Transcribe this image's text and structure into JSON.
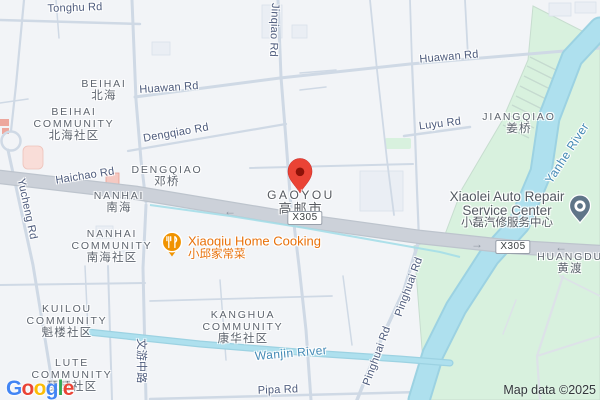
{
  "colors": {
    "background": "#f2f4f7",
    "green_area": "#d8f1de",
    "water_fill": "#a9dcec",
    "road_minor": "#cfd9e5",
    "road_major": "#c9ced7",
    "road_label": "#4d5b7c",
    "water_label": "#4389b5",
    "area_label": "#5d646e",
    "poi_orange": "#e8710a",
    "poi_gray_text": "#545a62",
    "pin_red": "#ea4335",
    "pin_gray": "#5f7588",
    "badge_border": "#99a1ab",
    "attribution_text": "#33373c"
  },
  "attribution": {
    "text": "Map data ©2025"
  },
  "logo": {
    "letters": [
      [
        "G",
        "#4285F4"
      ],
      [
        "o",
        "#EA4335"
      ],
      [
        "o",
        "#FBBC05"
      ],
      [
        "g",
        "#4285F4"
      ],
      [
        "l",
        "#34A853"
      ],
      [
        "e",
        "#EA4335"
      ]
    ]
  },
  "badges": [
    {
      "name": "route-badge-x305-west",
      "text": "X305",
      "x": 305,
      "y": 218
    },
    {
      "name": "route-badge-x305-east",
      "text": "X305",
      "x": 513,
      "y": 247
    }
  ],
  "arrows": [
    {
      "name": "oneway-arrow-west",
      "dir": "left",
      "x": 230,
      "y": 211
    },
    {
      "name": "oneway-arrow-mid",
      "dir": "right",
      "x": 477,
      "y": 244
    },
    {
      "name": "oneway-arrow-east",
      "dir": "left",
      "x": 561,
      "y": 247
    }
  ],
  "markers": [
    {
      "name": "destination-pin-gaoyou",
      "x": 300,
      "y": 176
    },
    {
      "name": "poi-pin-xiaoqiu-restaurant",
      "x": 172,
      "y": 242
    },
    {
      "name": "poi-pin-xiaolei-auto-repair",
      "x": 580,
      "y": 206
    }
  ],
  "labels": [
    {
      "name": "road-label-tonghu-rd",
      "cls": "road",
      "x": 75,
      "y": 8,
      "rot": -2,
      "lines": [
        "Tonghu Rd"
      ]
    },
    {
      "name": "road-label-huawan-rd-west",
      "cls": "road",
      "x": 169,
      "y": 88,
      "rot": -4,
      "lines": [
        "Huawan Rd"
      ]
    },
    {
      "name": "road-label-huawan-rd-east",
      "cls": "road",
      "x": 449,
      "y": 57,
      "rot": -5,
      "lines": [
        "Huawan Rd"
      ]
    },
    {
      "name": "road-label-jinqiao-rd",
      "cls": "road",
      "x": 274,
      "y": 30,
      "rot": 92,
      "lines": [
        "Jinqiao Rd"
      ]
    },
    {
      "name": "road-label-dengqiao-rd",
      "cls": "road",
      "x": 176,
      "y": 133,
      "rot": -10,
      "lines": [
        "Dengqiao Rd"
      ]
    },
    {
      "name": "road-label-haichao-rd",
      "cls": "road",
      "x": 85,
      "y": 176,
      "rot": -9,
      "lines": [
        "Haichao Rd"
      ]
    },
    {
      "name": "road-label-yucheng-rd",
      "cls": "road",
      "x": 27,
      "y": 209,
      "rot": 78,
      "lines": [
        "Yucheng Rd"
      ]
    },
    {
      "name": "road-label-luyu-rd",
      "cls": "road",
      "x": 440,
      "y": 124,
      "rot": -7,
      "lines": [
        "Luyu Rd"
      ]
    },
    {
      "name": "road-label-wenyou-middle-rd",
      "cls": "road",
      "x": 142,
      "y": 361,
      "rot": 90,
      "lines": [
        "文游中路"
      ]
    },
    {
      "name": "road-label-pipa-rd",
      "cls": "road",
      "x": 278,
      "y": 390,
      "rot": -2,
      "lines": [
        "Pipa Rd"
      ]
    },
    {
      "name": "road-label-pinghuai-rd-south",
      "cls": "road",
      "x": 377,
      "y": 356,
      "rot": -70,
      "lines": [
        "Pinghuai Rd"
      ]
    },
    {
      "name": "road-label-pinghuai-rd-north",
      "cls": "road",
      "x": 409,
      "y": 287,
      "rot": -70,
      "lines": [
        "Pinghuai Rd"
      ]
    },
    {
      "name": "water-label-yanhe-river",
      "cls": "water",
      "x": 567,
      "y": 153,
      "rot": -57,
      "lines": [
        "Yanhe River"
      ]
    },
    {
      "name": "water-label-wanjin-river",
      "cls": "water",
      "x": 291,
      "y": 353,
      "rot": -5,
      "lines": [
        "Wanjin River"
      ]
    },
    {
      "name": "area-label-beihai",
      "cls": "area",
      "x": 104,
      "y": 90,
      "lines": [
        "BEIHAI",
        "北海"
      ]
    },
    {
      "name": "area-label-beihai-community",
      "cls": "area",
      "x": 74,
      "y": 124,
      "lines": [
        "BEIHAI",
        "COMMUNITY",
        "北海社区"
      ]
    },
    {
      "name": "area-label-dengqiao",
      "cls": "area",
      "x": 167,
      "y": 176,
      "lines": [
        "DENGQIAO",
        "邓桥"
      ]
    },
    {
      "name": "area-label-nanhai",
      "cls": "area",
      "x": 119,
      "y": 202,
      "lines": [
        "NANHAI",
        "南海"
      ]
    },
    {
      "name": "area-label-nanhai-community",
      "cls": "area",
      "x": 112,
      "y": 246,
      "lines": [
        "NANHAI",
        "COMMUNITY",
        "南海社区"
      ]
    },
    {
      "name": "area-label-jiangqiao",
      "cls": "area",
      "x": 519,
      "y": 123,
      "lines": [
        "JIANGQIAO",
        "姜桥"
      ]
    },
    {
      "name": "area-label-huangdu",
      "cls": "area",
      "x": 570,
      "y": 263,
      "lines": [
        "HUANGDU",
        "黄渡"
      ]
    },
    {
      "name": "area-label-kuilou-community",
      "cls": "area",
      "x": 67,
      "y": 321,
      "lines": [
        "KUILOU",
        "COMMUNITY",
        "魁楼社区"
      ]
    },
    {
      "name": "area-label-lute-community",
      "cls": "area",
      "x": 72,
      "y": 375,
      "lines": [
        "LUTE",
        "COMMUNITY",
        "琵琶社区"
      ]
    },
    {
      "name": "area-label-kanghua-community",
      "cls": "area",
      "x": 243,
      "y": 327,
      "lines": [
        "KANGHUA",
        "COMMUNITY",
        "康华社区"
      ]
    },
    {
      "name": "city-label-gaoyou",
      "cls": "city",
      "x": 301,
      "y": 202,
      "lines": [
        "GAOYOU",
        "高邮市"
      ]
    },
    {
      "name": "poi-label-xiaoqiu-home-cooking",
      "cls": "poi-orange",
      "x": 188,
      "y": 248,
      "anchor": "left",
      "interactable": true,
      "lines": [
        "Xiaoqiu Home Cooking",
        "小邱家常菜"
      ]
    },
    {
      "name": "poi-label-xiaolei-auto-repair",
      "cls": "poi-gray",
      "x": 507,
      "y": 210,
      "interactable": true,
      "lines": [
        "Xiaolei Auto Repair",
        "Service Center",
        "小磊汽修服务中心"
      ]
    }
  ]
}
